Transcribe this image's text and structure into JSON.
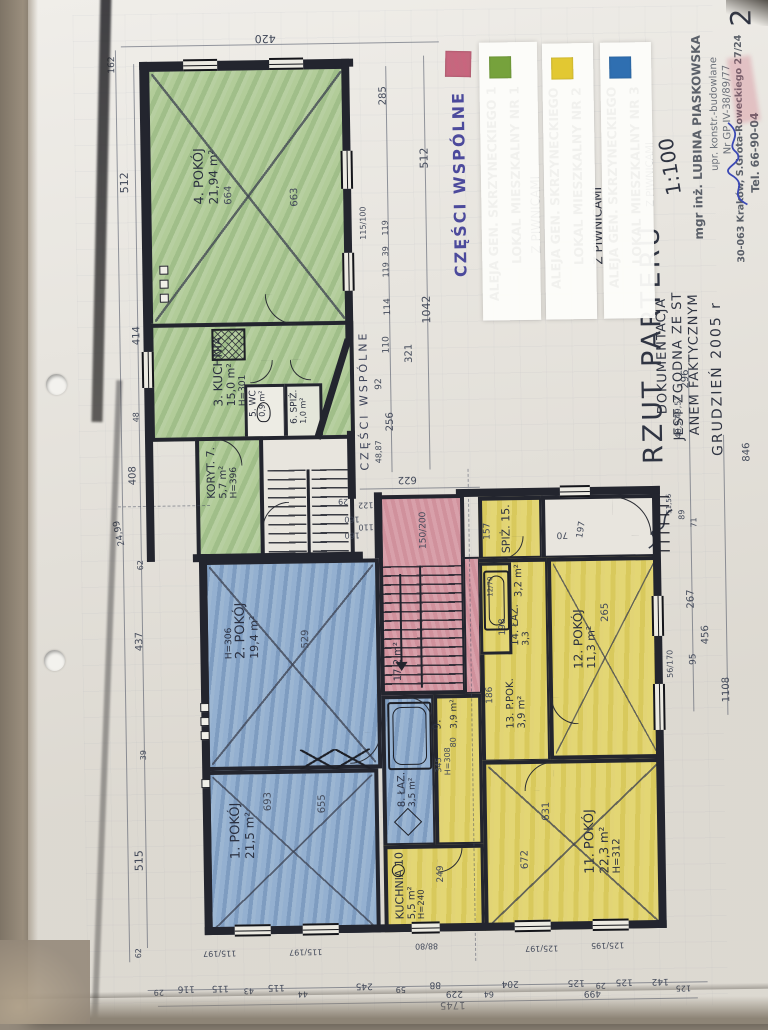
{
  "page": {
    "number": "2"
  },
  "legend": {
    "common": {
      "label": "CZĘŚCI WSPÓLNE",
      "color": "#c9647e"
    },
    "items": [
      {
        "color": "#76a23c",
        "line1": "ALEJA GEN. SKRZYNECKIEGO 1",
        "line2": "LOKAL MIESZKALNY NR 1",
        "note": "Z PIWNICAMI"
      },
      {
        "color": "#e2c832",
        "line1": "ALEJA GEN. SKRZYNECKIEGO",
        "line2": "LOKAL MIESZKALNY NR 2",
        "note": "Z PIWNICAMI"
      },
      {
        "color": "#2f6fb1",
        "line1": "ALEJA GEN. SKRZYNECKIEGO",
        "line2": "LOKAL MIESZKALNY NR 3",
        "note": "Z PIWNICAMI"
      }
    ]
  },
  "title": {
    "main": "RZUT PARTERU",
    "scale": "1:100"
  },
  "remark": {
    "l1": "DOKUMENTACJA",
    "l2": "JEST ZGODNA ZE ST",
    "l3": "ANEM FAKTYCZNYM",
    "l4": "GRUDZIEŃ 2005 r"
  },
  "stamp": {
    "l1": "mgr inż. LUBINA PIASKOWSKA",
    "l2": "upr. konstr.-budowlane",
    "l3": "Nr GP IV-38/89/77",
    "l4": "30-063 Kraków, S.Grota-Roweckiego 27/24",
    "l5": "Tel. 66-90-04"
  },
  "plan": {
    "common_area_label": "CZĘŚCI WSPÓLNE",
    "stair_area": "17,2 m²",
    "rooms": [
      {
        "label": "1. POKÓJ",
        "area": "21,5 m²",
        "h": "",
        "d1": "693",
        "d2": "655"
      },
      {
        "label": "2. POKÓJ",
        "area": "19,4 m²",
        "h": "H=306",
        "d1": "529",
        "d2": ""
      },
      {
        "label": "3. KUCHNIA",
        "area": "15,0 m²",
        "h": "H=301",
        "d1": "",
        "d2": ""
      },
      {
        "label": "4. POKÓJ",
        "area": "21,94 m²",
        "h": "",
        "d1": "664",
        "d2": "663"
      },
      {
        "label": "5. WC",
        "area": "0,9 m²",
        "h": "",
        "d1": "",
        "d2": ""
      },
      {
        "label": "6. SPIŻ.",
        "area": "1,0 m²",
        "h": "",
        "d1": "",
        "d2": ""
      },
      {
        "label": "KORYT. 7.",
        "area": "5,7 m²",
        "h": "H=396",
        "d1": "",
        "d2": ""
      },
      {
        "label": "8. ŁAZ.",
        "area": "3,5 m²",
        "h": "",
        "d1": "",
        "d2": ""
      },
      {
        "label": "9.",
        "area": "3,9 m²",
        "h": "H=308",
        "d1": "345",
        "d2": "80"
      },
      {
        "label": "KUCHNIA 10",
        "area": "5,5 m²",
        "h": "H=240",
        "d1": "249",
        "d2": ""
      },
      {
        "label": "11. POKÓJ",
        "area": "22,3 m²",
        "h": "H=312",
        "d1": "672",
        "d2": "631"
      },
      {
        "label": "12. POKÓJ",
        "area": "11,3 m²",
        "h": "",
        "d1": "265",
        "d2": ""
      },
      {
        "label": "13. P.POK.",
        "area": "3,9 m²",
        "h": "",
        "d1": "",
        "d2": ""
      },
      {
        "label": "14. ŁAZ.",
        "area": "3,3",
        "h": "",
        "d1": "",
        "d2": ""
      },
      {
        "label": "SPIŻ. 15.",
        "area": "3,2 m²",
        "h": "",
        "d1": "",
        "d2": ""
      }
    ],
    "dims": {
      "top": [
        "420"
      ],
      "left": [
        "162",
        "512",
        "414",
        "48",
        "408",
        "24,99",
        "62",
        "437",
        "39",
        "515",
        "62"
      ],
      "green": [
        "285",
        "512",
        "115/100",
        "119",
        "39",
        "119",
        "114",
        "110",
        "1042",
        "321",
        "92",
        "256",
        "48,87"
      ],
      "stairwell": [
        "622",
        "150/200",
        "29",
        "160",
        "160",
        "110",
        "122"
      ],
      "mid": [
        "186",
        "198",
        "157",
        "70",
        "197",
        "12/70"
      ],
      "right": [
        "296",
        "49,57",
        "48,97",
        "846",
        "51,56",
        "89",
        "71",
        "267",
        "456",
        "95",
        "56/170",
        "1108"
      ],
      "windows_bottom": [
        "115/197",
        "115/197",
        "88/80",
        "125/197",
        "125/195"
      ],
      "bottom": [
        "29",
        "116",
        "115",
        "43",
        "115",
        "44",
        "245",
        "59",
        "88",
        "229",
        "64",
        "204",
        "125",
        "29",
        "125",
        "499",
        "142",
        "125",
        "1745"
      ]
    }
  },
  "colors": {
    "green": "#c2d7ac",
    "yellow": "#e6da82",
    "blue": "#adc4dc",
    "pink": "#dca8b1",
    "legend_green": "#76a23c",
    "legend_yellow": "#e2c832",
    "legend_blue": "#2f6fb1",
    "legend_pink": "#c9647e"
  }
}
